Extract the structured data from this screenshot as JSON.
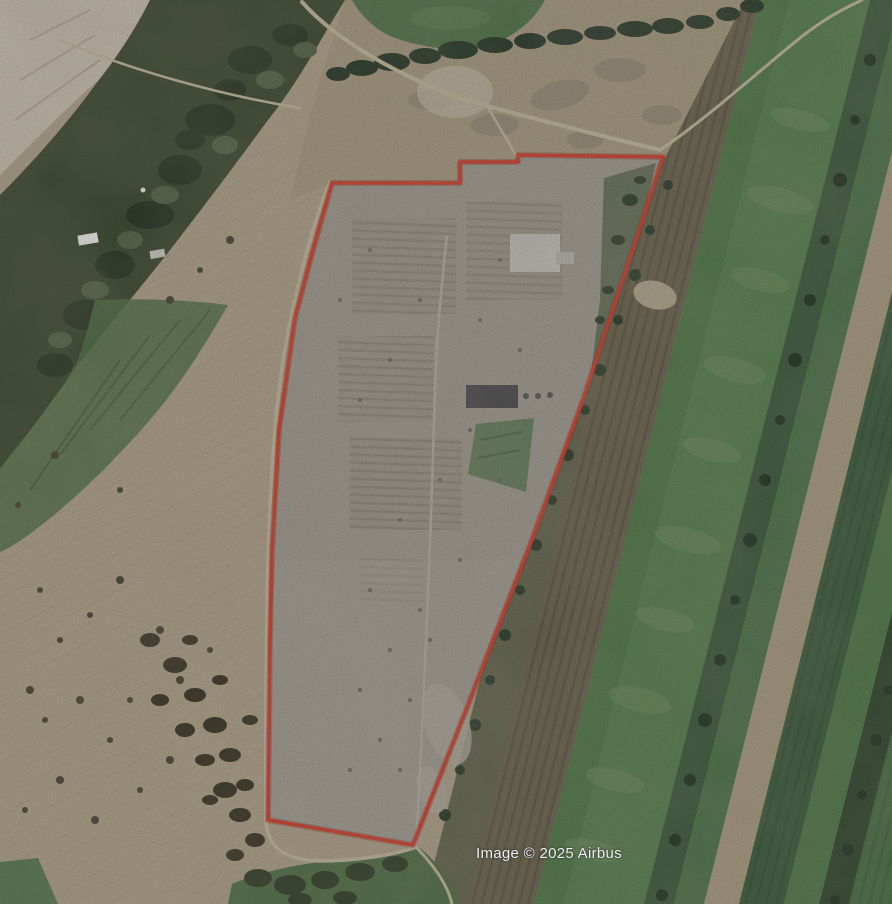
{
  "map": {
    "view_type": "satellite",
    "attribution": "Image © 2025 Airbus",
    "parcel": {
      "outline_points": "332,183 460,183 460,162 518,162 518,155 663,157 636,240 583,400 530,545 470,700 413,845 268,820 270,640 272,550 279,430 295,318 313,250",
      "outline_color": "#d8392b"
    },
    "colors": {
      "terrain_tan": "#b2a58e",
      "parcel_gray": "#a29e96",
      "field_green": "#558151",
      "forest_green": "#3a4931",
      "attribution_text": "#f2f2f2"
    }
  }
}
